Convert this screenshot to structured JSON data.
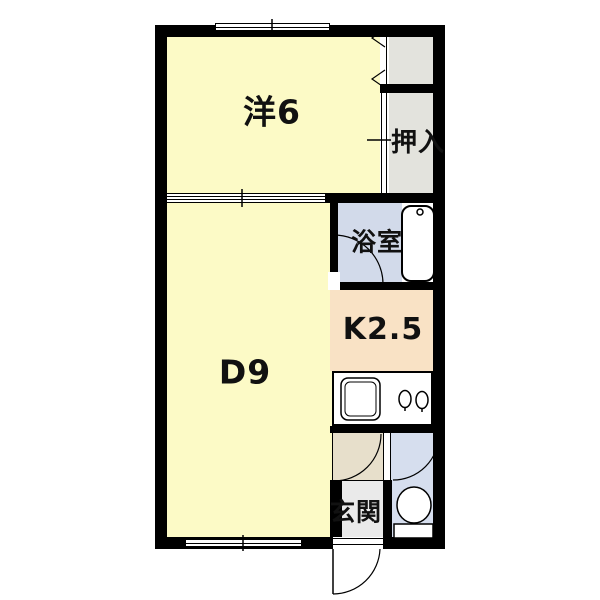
{
  "rooms": {
    "western": {
      "label": "洋6",
      "color": "#FCFAC6"
    },
    "closet_upper": {
      "label": "",
      "color": "#E3E3DD"
    },
    "oshiire": {
      "label": "押入",
      "color": "#E3E3DD"
    },
    "dining": {
      "label": "D9",
      "color": "#FCFAC6"
    },
    "bathroom": {
      "label": "浴室",
      "color": "#D2DAEA"
    },
    "kitchen": {
      "label": "K2.5",
      "color": "#F9E2C5"
    },
    "hallway": {
      "label": "",
      "color": "#E7DFCB"
    },
    "genkan": {
      "label": "玄関",
      "color": "#EAEAEA"
    },
    "toilet": {
      "label": "",
      "color": "#D6DEEE"
    }
  },
  "colors": {
    "wall": "#000000",
    "background": "#FFFFFF",
    "fixture_fill": "#FFFFFF",
    "line": "#000000"
  },
  "fixtures": {
    "bathtub": "bathtub with faucet dot",
    "kitchen_sink": "double-outline sink",
    "stove": "two-burner stove",
    "toilet": "toilet bowl with tank",
    "entrance_door": "outward-swinging hinged door",
    "window_top": "sliding window in top wall",
    "window_bottom": "sliding window in bottom wall",
    "sliding_door_rooms": "two-panel sliding door between 洋6 and D9",
    "sliding_door_oshiire": "sliding door on 押入 closet",
    "folding_door_closet": "folding door on upper closet",
    "hinged_doors": "bathroom, hallway and toilet door swing arcs"
  }
}
